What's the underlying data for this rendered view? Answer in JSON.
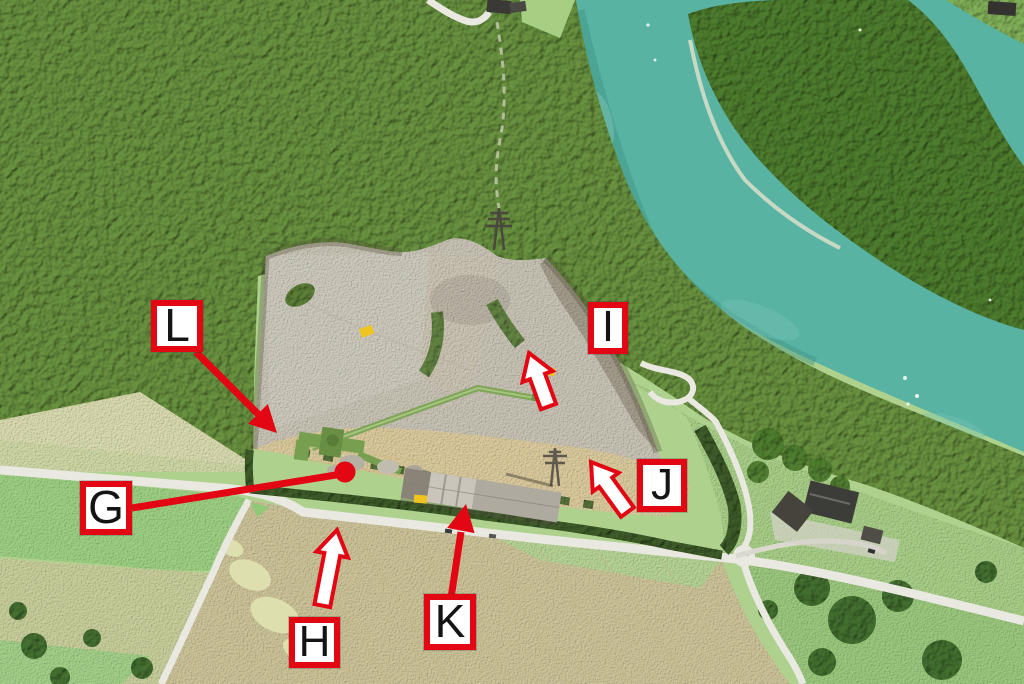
{
  "scene": {
    "kind": "aerial-photograph-of-gravel-quarry-by-river",
    "colors": {
      "water": "#58b3a3",
      "water_light": "#79c4b4",
      "forest": "#68913f",
      "forest_dark": "#4e7c2e",
      "meadow": "#aed28e",
      "meadow_bright": "#9ed184",
      "field_pale": "#d6d9a9",
      "field_crop": "#cdc499",
      "gravel": "#c9c4b6",
      "sand": "#dccb9e",
      "road": "#e9e8e1",
      "hedge": "#3e5c29",
      "machinery_green": "#7fa558",
      "machine_yellow": "#f0c41e",
      "roof_gray": "#9d988d"
    }
  },
  "annotations": {
    "colors": {
      "annotation_red": "#e30613",
      "label_background": "#ffffff",
      "label_text": "#141414",
      "white_arrow_fill": "#ffffff"
    },
    "labels": [
      {
        "letter": "G",
        "marker": "red-line-with-dot"
      },
      {
        "letter": "H",
        "marker": "white-arrow-pointing-up"
      },
      {
        "letter": "I",
        "marker": "white-arrow-pointing-up-left"
      },
      {
        "letter": "J",
        "marker": "white-arrow-pointing-up-left"
      },
      {
        "letter": "K",
        "marker": "red-arrow-pointing-up"
      },
      {
        "letter": "L",
        "marker": "red-arrow-pointing-down-right"
      }
    ]
  }
}
